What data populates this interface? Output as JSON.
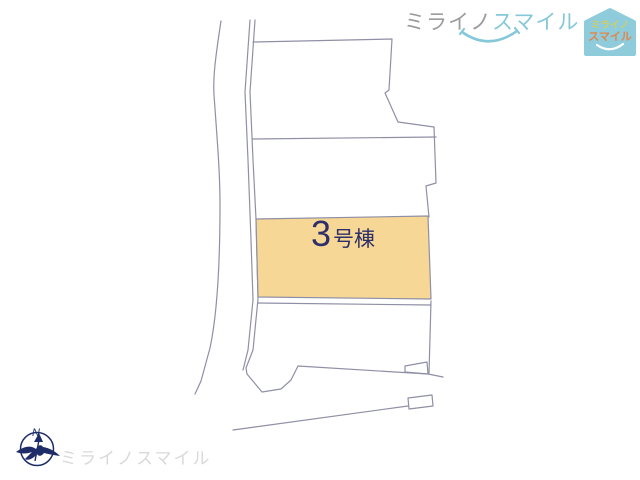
{
  "site_plan": {
    "lot_label": {
      "number": "3",
      "suffix": "号棟"
    },
    "colors": {
      "line": "#8f8fa6",
      "highlight_fill": "#f6d795",
      "label_text": "#2e2e68"
    }
  },
  "header_logo": {
    "text_part1": "ミライノ",
    "text_part2": "スマイル",
    "colors": {
      "part1": "#9c9c9c",
      "part2": "#85c8d9",
      "smile_arc": "#85c8d9"
    }
  },
  "house_badge": {
    "line1": "ミライノ",
    "line2": "スマイル",
    "colors": {
      "background": "#8fccdb",
      "line1": "#d2cd62",
      "line2": "#e0854c",
      "smile": "#ffffff"
    }
  },
  "compass": {
    "north_label": "N",
    "color": "#1e2d69"
  },
  "footer_logo": {
    "text": "ミライノスマイル",
    "color": "#d9d9d9"
  }
}
